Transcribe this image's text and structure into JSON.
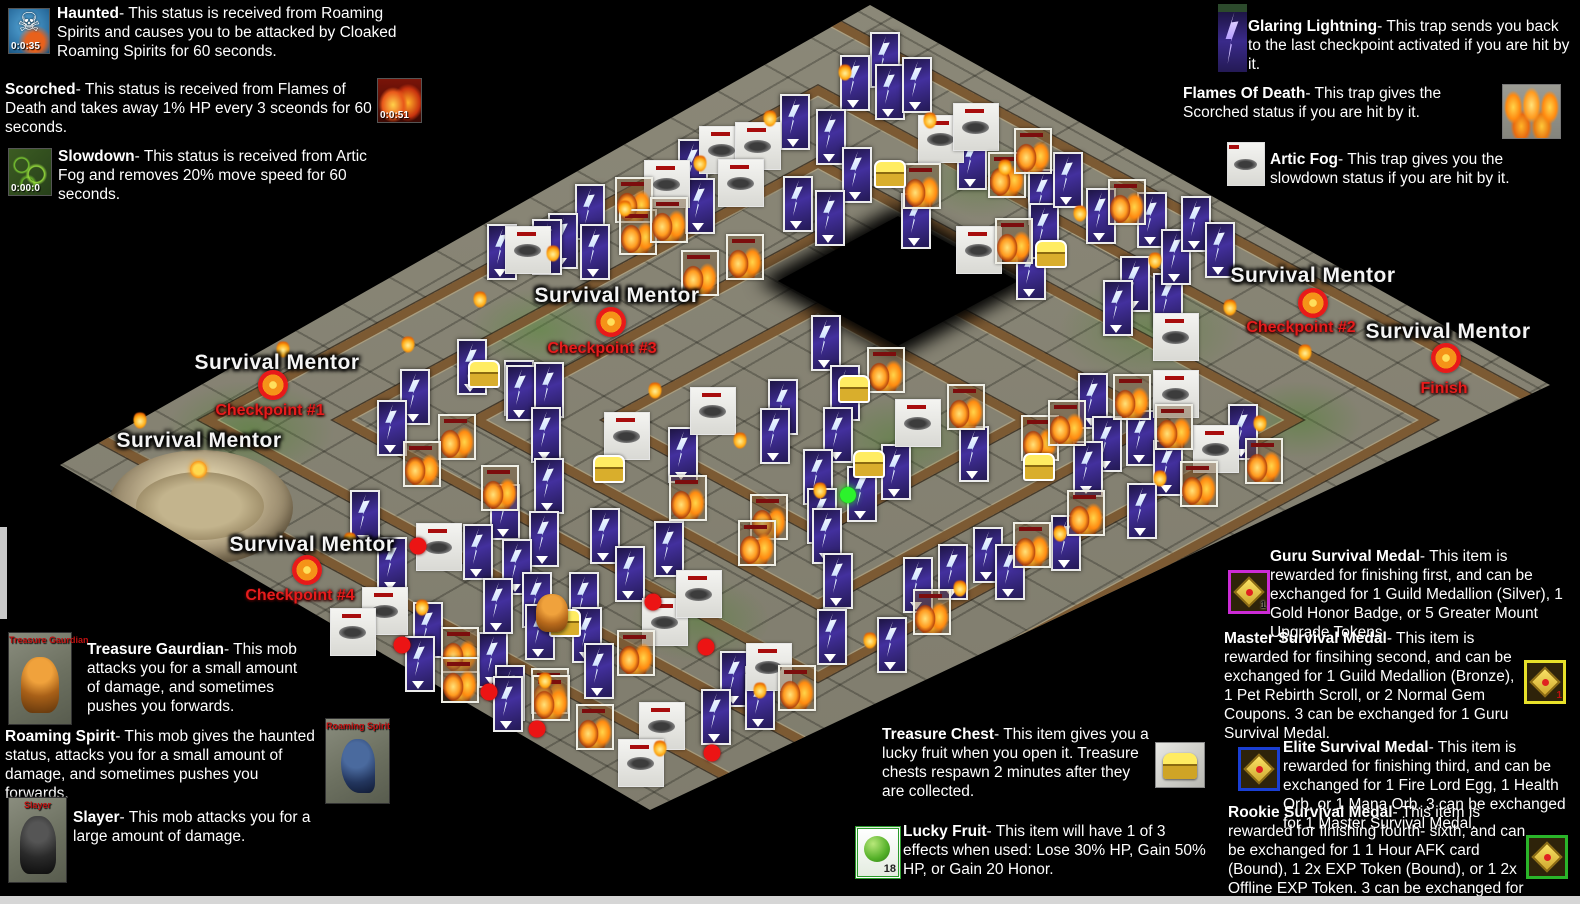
{
  "icons": {
    "skull_glyph": "☠"
  },
  "legend": {
    "haunted": {
      "name": "Haunted",
      "desc": "- This status is received from Roaming Spirits and causes you to be attacked by Cloaked Roaming Spirits for 60 seconds.",
      "timer": "0:0:35"
    },
    "scorched": {
      "name": "Scorched",
      "desc": "- This status is received from Flames of Death and takes away 1% HP every 3 sceonds for 60 seconds.",
      "timer": "0:0:51"
    },
    "slowdown": {
      "name": "Slowdown",
      "desc": "- This status is received from Artic Fog and removes 20% move speed for 60 seconds.",
      "timer": "0:00:0"
    },
    "glaring_lightning": {
      "name": "Glaring Lightning",
      "desc": "- This trap sends you back to the last checkpoint activated if you are hit by it."
    },
    "flames_of_death": {
      "name": "Flames Of Death",
      "desc": "- This trap gives the Scorched status if you are hit by it."
    },
    "artic_fog": {
      "name": "Artic Fog",
      "desc": "- This trap gives you the slowdown status if you are hit by it."
    },
    "treasure_gaurdian": {
      "name": "Treasure Gaurdian",
      "desc": "- This mob attacks you for a small amount of damage, and sometimes pushes you forwards.",
      "portrait_label": "Treasure Gaurdian"
    },
    "roaming_spirit": {
      "name": "Roaming Spirit",
      "desc": "- This mob gives the haunted status, attacks you for a small amount of damage, and sometimes pushes you forwards.",
      "portrait_label": "Roaming Spirit"
    },
    "slayer": {
      "name": "Slayer",
      "desc": "- This mob attacks you for a large amount of damage.",
      "portrait_label": "Slayer"
    },
    "treasure_chest": {
      "name": "Treasure Chest",
      "desc": "- This item gives you a lucky fruit when you open it. Treasure chests respawn 2 minutes after they are collected."
    },
    "lucky_fruit": {
      "name": "Lucky Fruit",
      "desc": "- This item will have 1 of 3 effects when used: Lose 30% HP, Gain 50% HP, or Gain 20 Honor.",
      "count": "18"
    },
    "guru_medal": {
      "name": "Guru Survival Medal",
      "desc": "- This item is rewarded for finishing first, and can be exchanged for 1 Guild Medallion (Silver), 1 Gold Honor Badge, or 5 Greater Mount Upgrade Tokens.",
      "count": "1"
    },
    "master_medal": {
      "name": "Master Survival Medal",
      "desc": "- This item is rewarded for finsihing second, and can be exchanged for 1 Guild Medallion (Bronze), 1 Pet Rebirth Scroll, or 2 Normal Gem Coupons. 3 can be exchanged for 1 Guru Survival Medal.",
      "count": "1"
    },
    "elite_medal": {
      "name": "Elite Survival Medal",
      "desc": "- This item is rewarded for finishing third, and can be exchanged for 1 Fire Lord Egg, 1 Health Orb, or 1 Mana Orb. 3 can be exchanged for 1 Master Survival Medal."
    },
    "rookie_medal": {
      "name": "Rookie Survival Medal",
      "desc": "- This item is rewarded for finishing fourth- sixth, and can be exchanged for 1 1 Hour AFK card (Bound), 1 2x EXP Token (Bound), or 1 2x Offline EXP Token. 3 can be exchanged for 1 Elite Survival Medal."
    }
  },
  "map": {
    "mentor_label": "Survival Mentor",
    "mentor_positions": [
      [
        277,
        363
      ],
      [
        199,
        441
      ],
      [
        617,
        296
      ],
      [
        312,
        545
      ],
      [
        1313,
        276
      ],
      [
        1448,
        332
      ]
    ],
    "checkpoints": [
      {
        "label": "Checkpoint #1",
        "marker": [
          273,
          385
        ],
        "text": [
          270,
          411
        ]
      },
      {
        "label": "Checkpoint #2",
        "marker": [
          1313,
          303
        ],
        "text": [
          1301,
          328
        ]
      },
      {
        "label": "Checkpoint #3",
        "marker": [
          611,
          322
        ],
        "text": [
          602,
          349
        ]
      },
      {
        "label": "Checkpoint #4",
        "marker": [
          307,
          570
        ],
        "text": [
          300,
          596
        ]
      },
      {
        "label": "Finish",
        "marker": [
          1446,
          358
        ],
        "text": [
          1444,
          389
        ]
      }
    ],
    "sprites": {
      "lightning": [
        [
          885,
          60
        ],
        [
          890,
          92
        ],
        [
          855,
          83
        ],
        [
          917,
          85
        ],
        [
          795,
          122
        ],
        [
          831,
          137
        ],
        [
          857,
          175
        ],
        [
          798,
          204
        ],
        [
          830,
          218
        ],
        [
          916,
          221
        ],
        [
          972,
          162
        ],
        [
          1031,
          272
        ],
        [
          1043,
          197
        ],
        [
          1044,
          231
        ],
        [
          1068,
          180
        ],
        [
          1101,
          216
        ],
        [
          1135,
          284
        ],
        [
          1152,
          220
        ],
        [
          1168,
          301
        ],
        [
          1176,
          257
        ],
        [
          1196,
          224
        ],
        [
          1220,
          250
        ],
        [
          1118,
          308
        ],
        [
          693,
          167
        ],
        [
          700,
          206
        ],
        [
          590,
          212
        ],
        [
          563,
          241
        ],
        [
          595,
          252
        ],
        [
          502,
          252
        ],
        [
          547,
          247
        ],
        [
          472,
          367
        ],
        [
          519,
          388
        ],
        [
          415,
          397
        ],
        [
          392,
          428
        ],
        [
          521,
          393
        ],
        [
          549,
          390
        ],
        [
          546,
          435
        ],
        [
          505,
          512
        ],
        [
          549,
          486
        ],
        [
          544,
          539
        ],
        [
          683,
          455
        ],
        [
          605,
          536
        ],
        [
          669,
          549
        ],
        [
          630,
          574
        ],
        [
          783,
          407
        ],
        [
          775,
          436
        ],
        [
          478,
          552
        ],
        [
          517,
          567
        ],
        [
          392,
          565
        ],
        [
          365,
          518
        ],
        [
          428,
          630
        ],
        [
          420,
          664
        ],
        [
          493,
          660
        ],
        [
          510,
          693
        ],
        [
          537,
          600
        ],
        [
          540,
          632
        ],
        [
          584,
          600
        ],
        [
          587,
          635
        ],
        [
          599,
          671
        ],
        [
          735,
          679
        ],
        [
          760,
          694
        ],
        [
          826,
          343
        ],
        [
          845,
          393
        ],
        [
          838,
          435
        ],
        [
          974,
          454
        ],
        [
          896,
          472
        ],
        [
          862,
          494
        ],
        [
          818,
          477
        ],
        [
          822,
          516
        ],
        [
          827,
          536
        ],
        [
          838,
          581
        ],
        [
          832,
          637
        ],
        [
          892,
          645
        ],
        [
          1093,
          401
        ],
        [
          1107,
          444
        ],
        [
          1088,
          469
        ],
        [
          1141,
          438
        ],
        [
          1168,
          468
        ],
        [
          1243,
          432
        ],
        [
          1142,
          511
        ],
        [
          1066,
          543
        ],
        [
          988,
          555
        ],
        [
          1010,
          572
        ],
        [
          953,
          572
        ],
        [
          918,
          585
        ],
        [
          760,
          702
        ],
        [
          716,
          717
        ],
        [
          508,
          704
        ],
        [
          498,
          606
        ]
      ],
      "fog": [
        [
          722,
          150
        ],
        [
          758,
          146
        ],
        [
          667,
          184
        ],
        [
          741,
          183
        ],
        [
          528,
          250
        ],
        [
          941,
          139
        ],
        [
          976,
          127
        ],
        [
          979,
          250
        ],
        [
          1176,
          337
        ],
        [
          713,
          411
        ],
        [
          627,
          436
        ],
        [
          439,
          547
        ],
        [
          385,
          611
        ],
        [
          353,
          632
        ],
        [
          665,
          622
        ],
        [
          699,
          594
        ],
        [
          769,
          667
        ],
        [
          918,
          423
        ],
        [
          1176,
          394
        ],
        [
          1216,
          449
        ],
        [
          662,
          726
        ],
        [
          641,
          763
        ]
      ],
      "fire": [
        [
          634,
          200
        ],
        [
          638,
          232
        ],
        [
          669,
          220
        ],
        [
          745,
          257
        ],
        [
          700,
          273
        ],
        [
          922,
          186
        ],
        [
          1007,
          175
        ],
        [
          1033,
          151
        ],
        [
          1014,
          241
        ],
        [
          1127,
          202
        ],
        [
          457,
          437
        ],
        [
          422,
          464
        ],
        [
          500,
          488
        ],
        [
          688,
          498
        ],
        [
          769,
          517
        ],
        [
          757,
          543
        ],
        [
          460,
          650
        ],
        [
          460,
          680
        ],
        [
          636,
          653
        ],
        [
          550,
          691
        ],
        [
          797,
          688
        ],
        [
          886,
          370
        ],
        [
          966,
          407
        ],
        [
          1040,
          438
        ],
        [
          1067,
          423
        ],
        [
          1132,
          397
        ],
        [
          1174,
          427
        ],
        [
          1199,
          484
        ],
        [
          1264,
          461
        ],
        [
          1086,
          513
        ],
        [
          1032,
          545
        ],
        [
          932,
          612
        ],
        [
          595,
          727
        ],
        [
          551,
          698
        ]
      ],
      "chest": [
        [
          890,
          174
        ],
        [
          1051,
          254
        ],
        [
          484,
          374
        ],
        [
          609,
          469
        ],
        [
          854,
          389
        ],
        [
          869,
          464
        ],
        [
          1039,
          467
        ],
        [
          565,
          623
        ]
      ],
      "red_dot": [
        [
          418,
          546
        ],
        [
          402,
          645
        ],
        [
          489,
          692
        ],
        [
          537,
          729
        ],
        [
          653,
          602
        ],
        [
          706,
          647
        ],
        [
          712,
          753
        ]
      ],
      "green_dot": [
        [
          848,
          495
        ]
      ],
      "guardian": [
        [
          552,
          613
        ]
      ],
      "torch": [
        [
          845,
          72
        ],
        [
          770,
          118
        ],
        [
          700,
          163
        ],
        [
          625,
          208
        ],
        [
          553,
          253
        ],
        [
          480,
          299
        ],
        [
          408,
          344
        ],
        [
          283,
          349
        ],
        [
          140,
          420
        ],
        [
          350,
          540
        ],
        [
          422,
          607
        ],
        [
          545,
          680
        ],
        [
          660,
          748
        ],
        [
          760,
          690
        ],
        [
          870,
          640
        ],
        [
          960,
          588
        ],
        [
          1060,
          533
        ],
        [
          1160,
          478
        ],
        [
          1260,
          423
        ],
        [
          930,
          120
        ],
        [
          1005,
          167
        ],
        [
          1080,
          213
        ],
        [
          1155,
          260
        ],
        [
          1230,
          307
        ],
        [
          1305,
          352
        ],
        [
          655,
          390
        ],
        [
          740,
          440
        ],
        [
          820,
          490
        ]
      ]
    }
  },
  "colors": {
    "background": "#000000",
    "ground": "#8b8878",
    "wall": "#7c5a33",
    "checkpoint_text": "#e61c1c",
    "mentor_text": "#f4f4f4",
    "guru_border": "#cc2bd6",
    "master_border": "#e8e12a",
    "elite_border": "#1a3fd4",
    "rookie_border": "#2ab52a"
  }
}
